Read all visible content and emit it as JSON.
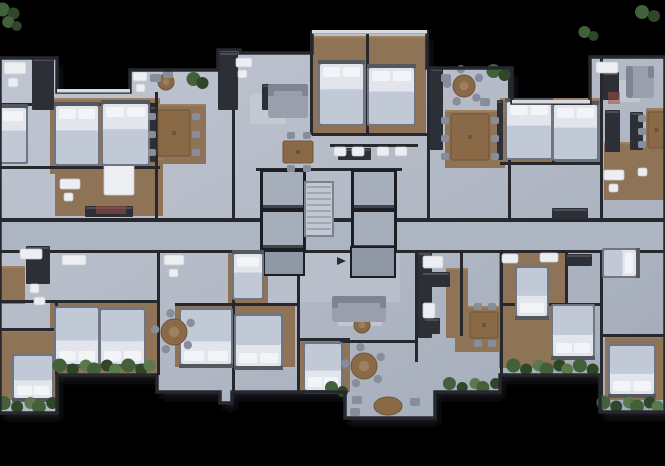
{
  "scene": {
    "w": 665,
    "h": 466,
    "bg": "#000000",
    "label": "residential-floor-plan-top-view"
  },
  "palette": {
    "floorA": "#bcc2cd",
    "floorB": "#a6adbb",
    "corridor": "#aeb5c2",
    "lobby": "#b9bfca",
    "wood": "#8e7356",
    "woodDark": "#7c6349",
    "woodLight": "#9e8061",
    "wall": "#26282e",
    "wallLight": "#d8dbe1",
    "bedSheet": "#e2e5eb",
    "bedBlanket": "#c2c9d6",
    "pillow": "#f2f4f7",
    "bedFrame": "#6f7582",
    "headboard": "#54585f",
    "tableWood": "#8a6a46",
    "tableWoodDark": "#6f5436",
    "chair": "#878e9b",
    "sofa": "#99a0ac",
    "sofaDark": "#7e8491",
    "counter": "#2c2f35",
    "fixture": "#eceef2",
    "fixtureEdge": "#c6cbd3",
    "plant": "#42603a",
    "plantDark": "#2f4629",
    "plantLight": "#5a7a4d",
    "shaftFrame": "#1c1e23",
    "shaftFill": "#a6adbb",
    "panel": "#8f96a4",
    "stair": "#c2c7d1",
    "stairLine": "#8d94a2",
    "rug": "#c7ccd5",
    "accent": "#9c4f41",
    "shadow": "#15171d"
  },
  "footprint": {
    "outline": [
      [
        0,
        58
      ],
      [
        57,
        58
      ],
      [
        57,
        92
      ],
      [
        130,
        92
      ],
      [
        130,
        70
      ],
      [
        218,
        70
      ],
      [
        218,
        50
      ],
      [
        240,
        50
      ],
      [
        240,
        53
      ],
      [
        312,
        53
      ],
      [
        312,
        32
      ],
      [
        427,
        32
      ],
      [
        427,
        68
      ],
      [
        512,
        68
      ],
      [
        512,
        103
      ],
      [
        590,
        103
      ],
      [
        590,
        57
      ],
      [
        665,
        57
      ],
      [
        665,
        412
      ],
      [
        600,
        412
      ],
      [
        600,
        375
      ],
      [
        500,
        375
      ],
      [
        500,
        392
      ],
      [
        435,
        392
      ],
      [
        435,
        418
      ],
      [
        345,
        418
      ],
      [
        345,
        392
      ],
      [
        232,
        392
      ],
      [
        232,
        403
      ],
      [
        220,
        403
      ],
      [
        220,
        392
      ],
      [
        157,
        392
      ],
      [
        157,
        375
      ],
      [
        57,
        375
      ],
      [
        57,
        413
      ],
      [
        0,
        413
      ]
    ]
  },
  "zones": {
    "corridor": [
      0,
      222,
      665,
      30
    ],
    "lobby": [
      256,
      252,
      144,
      50
    ]
  },
  "woodAreas": [
    [
      50,
      98,
      110,
      76
    ],
    [
      312,
      36,
      114,
      98
    ],
    [
      500,
      98,
      102,
      64
    ],
    [
      148,
      104,
      58,
      60
    ],
    [
      445,
      110,
      60,
      58
    ],
    [
      604,
      142,
      61,
      58
    ],
    [
      55,
      158,
      108,
      58
    ],
    [
      646,
      108,
      19,
      40
    ],
    [
      50,
      300,
      110,
      75
    ],
    [
      0,
      330,
      57,
      70
    ],
    [
      175,
      303,
      120,
      64
    ],
    [
      300,
      340,
      50,
      52
    ],
    [
      455,
      306,
      48,
      46
    ],
    [
      446,
      268,
      22,
      70
    ],
    [
      499,
      250,
      66,
      118
    ],
    [
      605,
      336,
      60,
      64
    ],
    [
      228,
      252,
      40,
      52
    ],
    [
      0,
      266,
      25,
      38
    ]
  ],
  "walls": [
    [
      0,
      103,
      158,
      3
    ],
    [
      0,
      166,
      160,
      3
    ],
    [
      155,
      92,
      3,
      130
    ],
    [
      232,
      53,
      3,
      169
    ],
    [
      310,
      32,
      3,
      103
    ],
    [
      366,
      34,
      3,
      99
    ],
    [
      427,
      68,
      3,
      154
    ],
    [
      508,
      68,
      3,
      154
    ],
    [
      552,
      103,
      3,
      60
    ],
    [
      500,
      162,
      102,
      3
    ],
    [
      600,
      57,
      3,
      165
    ],
    [
      312,
      133,
      116,
      3
    ],
    [
      330,
      144,
      88,
      3
    ],
    [
      256,
      168,
      146,
      3
    ],
    [
      0,
      218,
      665,
      4
    ],
    [
      0,
      250,
      665,
      3
    ],
    [
      157,
      252,
      3,
      123
    ],
    [
      232,
      252,
      3,
      140
    ],
    [
      297,
      252,
      3,
      140
    ],
    [
      415,
      252,
      3,
      110
    ],
    [
      460,
      252,
      3,
      84
    ],
    [
      500,
      252,
      3,
      123
    ],
    [
      565,
      252,
      3,
      92
    ],
    [
      600,
      252,
      3,
      160
    ],
    [
      55,
      302,
      3,
      73
    ],
    [
      0,
      300,
      160,
      3
    ],
    [
      0,
      328,
      57,
      3
    ],
    [
      175,
      303,
      122,
      3
    ],
    [
      300,
      338,
      50,
      3
    ],
    [
      500,
      303,
      102,
      3
    ],
    [
      600,
      334,
      65,
      3
    ],
    [
      340,
      340,
      78,
      3
    ]
  ],
  "lightWalls": [
    [
      312,
      30,
      115,
      3.5
    ],
    [
      57,
      89,
      73,
      3.5
    ],
    [
      512,
      100,
      78,
      3.5
    ]
  ],
  "core": {
    "shafts": [
      [
        263,
        172,
        40,
        36
      ],
      [
        263,
        212,
        40,
        36
      ],
      [
        354,
        172,
        40,
        36
      ],
      [
        354,
        212,
        40,
        36
      ]
    ],
    "stairs": [
      306,
      183,
      26,
      52
    ],
    "panels": [
      [
        265,
        252,
        38,
        22
      ],
      [
        352,
        248,
        42,
        28
      ]
    ],
    "arrow": [
      337,
      261
    ]
  },
  "beds": [
    [
      56,
      106,
      42,
      58,
      "n"
    ],
    [
      103,
      104,
      45,
      60,
      "n"
    ],
    [
      0,
      108,
      26,
      54,
      "n"
    ],
    [
      320,
      64,
      43,
      60,
      "n"
    ],
    [
      369,
      68,
      45,
      56,
      "n"
    ],
    [
      507,
      102,
      44,
      56,
      "n"
    ],
    [
      554,
      105,
      43,
      54,
      "n"
    ],
    [
      56,
      308,
      42,
      56,
      "s"
    ],
    [
      101,
      310,
      43,
      54,
      "s"
    ],
    [
      14,
      356,
      38,
      42,
      "s"
    ],
    [
      181,
      310,
      50,
      54,
      "s"
    ],
    [
      236,
      316,
      45,
      50,
      "s"
    ],
    [
      305,
      344,
      36,
      46,
      "s"
    ],
    [
      517,
      268,
      30,
      48,
      "s"
    ],
    [
      553,
      306,
      40,
      50,
      "s"
    ],
    [
      610,
      346,
      44,
      48,
      "s"
    ],
    [
      604,
      250,
      32,
      26,
      "e"
    ],
    [
      234,
      254,
      28,
      44,
      "n"
    ]
  ],
  "tablesRect": [
    [
      158,
      110,
      32,
      46,
      "v"
    ],
    [
      283,
      141,
      30,
      22,
      "h"
    ],
    [
      451,
      114,
      38,
      46,
      "v"
    ],
    [
      648,
      112,
      17,
      36,
      "v"
    ],
    [
      470,
      312,
      28,
      26,
      "h"
    ]
  ],
  "tablesRound": [
    [
      166,
      82,
      8
    ],
    [
      464,
      86,
      11
    ],
    [
      174,
      332,
      13
    ],
    [
      362,
      325,
      8
    ],
    [
      364,
      366,
      13
    ]
  ],
  "tablesOval": [
    [
      388,
      406,
      14,
      9
    ]
  ],
  "sofas": [
    [
      268,
      84,
      40,
      34,
      "n"
    ],
    [
      626,
      66,
      28,
      32,
      "w"
    ],
    [
      332,
      296,
      54,
      26,
      "n"
    ]
  ],
  "counters": [
    [
      218,
      52,
      20,
      58
    ],
    [
      430,
      68,
      13,
      82
    ],
    [
      32,
      58,
      22,
      52
    ],
    [
      85,
      206,
      48,
      11
    ],
    [
      552,
      208,
      36,
      11
    ],
    [
      262,
      84,
      13,
      26
    ],
    [
      338,
      148,
      33,
      12
    ],
    [
      605,
      110,
      15,
      42
    ],
    [
      630,
      112,
      13,
      38
    ],
    [
      418,
      252,
      14,
      86
    ],
    [
      422,
      272,
      28,
      15
    ],
    [
      424,
      318,
      16,
      16
    ],
    [
      26,
      246,
      24,
      38
    ],
    [
      566,
      254,
      26,
      12
    ],
    [
      603,
      72,
      16,
      28
    ],
    [
      150,
      106,
      6,
      56
    ],
    [
      497,
      100,
      6,
      60
    ]
  ],
  "fixtures": [
    [
      4,
      62,
      22,
      12
    ],
    [
      8,
      78,
      10,
      9
    ],
    [
      133,
      72,
      14,
      9
    ],
    [
      136,
      84,
      9,
      8
    ],
    [
      104,
      163,
      30,
      32
    ],
    [
      60,
      179,
      20,
      10
    ],
    [
      64,
      193,
      9,
      8
    ],
    [
      334,
      147,
      12,
      9
    ],
    [
      352,
      147,
      12,
      9
    ],
    [
      377,
      147,
      12,
      9
    ],
    [
      395,
      147,
      12,
      9
    ],
    [
      596,
      62,
      22,
      11
    ],
    [
      604,
      170,
      20,
      10
    ],
    [
      609,
      184,
      9,
      8
    ],
    [
      638,
      168,
      9,
      8
    ],
    [
      20,
      249,
      22,
      10
    ],
    [
      30,
      284,
      9,
      9
    ],
    [
      34,
      297,
      11,
      8
    ],
    [
      62,
      255,
      24,
      10
    ],
    [
      164,
      255,
      20,
      10
    ],
    [
      169,
      269,
      9,
      8
    ],
    [
      540,
      253,
      18,
      9
    ],
    [
      502,
      254,
      16,
      9
    ],
    [
      423,
      256,
      20,
      12
    ],
    [
      423,
      303,
      12,
      15
    ],
    [
      236,
      58,
      16,
      9
    ],
    [
      238,
      70,
      9,
      8
    ]
  ],
  "rugs": [
    [
      250,
      94,
      36,
      30
    ],
    [
      612,
      80,
      28,
      22
    ],
    [
      338,
      306,
      44,
      20
    ]
  ],
  "chairsExtra": [
    [
      150,
      74,
      11,
      8
    ],
    [
      163,
      70,
      10,
      8
    ],
    [
      441,
      74,
      10,
      8
    ],
    [
      480,
      98,
      10,
      8
    ],
    [
      352,
      396,
      10,
      8
    ],
    [
      350,
      408,
      10,
      8
    ],
    [
      410,
      398,
      10,
      8
    ]
  ],
  "accents": [
    [
      608,
      92,
      12,
      12
    ],
    [
      96,
      206,
      30,
      8
    ]
  ],
  "plants": [
    [
      0,
      5,
      18,
      13
    ],
    [
      7,
      19,
      13,
      10
    ],
    [
      583,
      29,
      14,
      10
    ],
    [
      639,
      8,
      20,
      12
    ],
    [
      491,
      65,
      18,
      16
    ],
    [
      192,
      73,
      14,
      16
    ],
    [
      56,
      361,
      100,
      13
    ],
    [
      0,
      398,
      57,
      14
    ],
    [
      510,
      361,
      86,
      13
    ],
    [
      600,
      398,
      65,
      13
    ],
    [
      329,
      384,
      18,
      11
    ],
    [
      446,
      380,
      54,
      11
    ]
  ]
}
